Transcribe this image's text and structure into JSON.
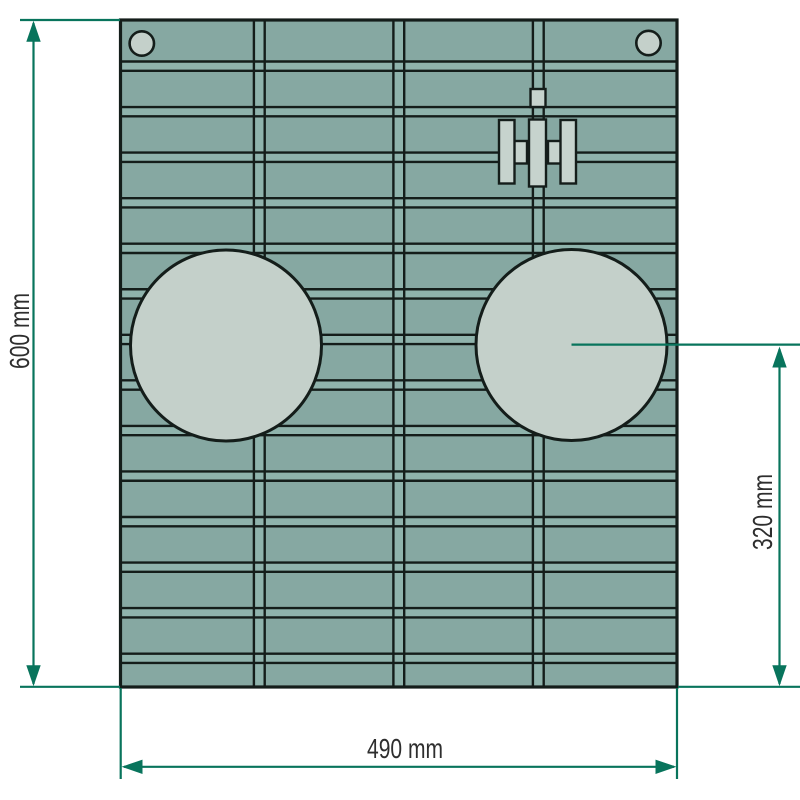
{
  "drawing": {
    "type": "technical-dimension-drawing",
    "subject": "tractor-front-grille-panel",
    "labels": {
      "height": "600 mm",
      "width": "490 mm",
      "light_center": "320 mm"
    },
    "dimensions_mm": {
      "panel_height": 600,
      "panel_width": 490,
      "light_center_from_bottom": 320
    },
    "grille": {
      "slat_rows": 14,
      "slat_columns": 4,
      "headlight_holes": 2,
      "mounting_holes": 2,
      "logo": "IH-logo"
    },
    "colors": {
      "background": "#ffffff",
      "grille_slat": "#86a8a2",
      "grille_gap_strip": "#8fb3ac",
      "outline_dark": "#141d1a",
      "hole_fill": "#c4d0ca",
      "dimension_green": "#08745c",
      "label_text": "#2e2e2e"
    }
  }
}
